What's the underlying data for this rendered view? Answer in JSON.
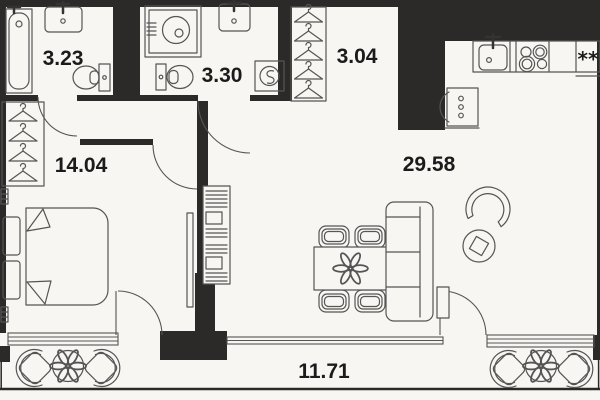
{
  "colors": {
    "background": "#f7f6f3",
    "wall": "#2b2a28",
    "line": "#555555",
    "dark_line": "#333333",
    "label": "#1b1b1b"
  },
  "rooms": [
    {
      "id": "bathroom",
      "area": "3.23"
    },
    {
      "id": "shower-room",
      "area": "3.30"
    },
    {
      "id": "wardrobe",
      "area": "3.04"
    },
    {
      "id": "bedroom",
      "area": "14.04"
    },
    {
      "id": "living-kitchen",
      "area": "29.58"
    },
    {
      "id": "terrace",
      "area": "11.71"
    }
  ],
  "kitchen": {
    "fridge_glyph": "**"
  },
  "icons": {
    "bathtub": "bathtub-top-view",
    "sink": "washbasin-with-tap",
    "toilet": "toilet-top-view",
    "shower": "shower-cabin",
    "washing_machine": "washing-machine-front-load",
    "hanger": "clothes-hanger",
    "bed": "double-bed-with-pillows",
    "tv": "wall-mounted-tv",
    "shelving": "shelving-with-books",
    "dining_table": "table-4-chairs-with-plant",
    "sofa": "three-seat-sofa",
    "armchair": "lounge-armchair",
    "plant": "flower-cluster",
    "cooktop": "4-burner-hob",
    "fridge": "fridge-snowflakes",
    "water_heater": "boiler-with-drops",
    "radiator": "wall-radiator",
    "window": "4-line-window-band",
    "door": "quarter-circle-swing-arc"
  }
}
